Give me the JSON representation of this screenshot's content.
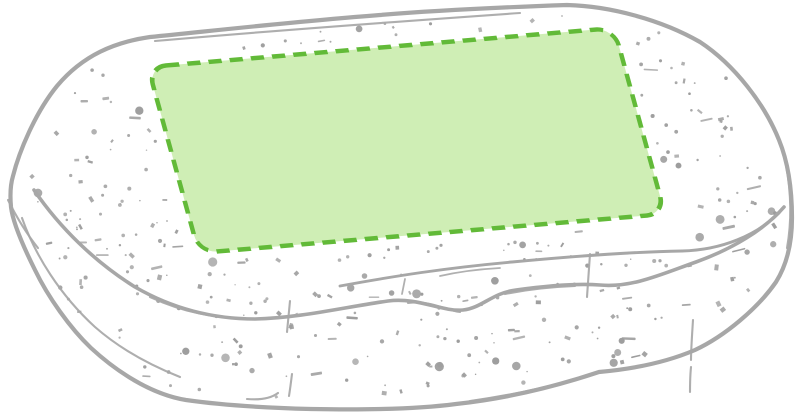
{
  "illustration": {
    "description": "Line-art drawing of a speckled oval box with the printable marking area highlighted in green on the lid",
    "background": "#ffffff"
  },
  "colors": {
    "outline": "#a7a7a7",
    "speckle": "#9d9d9d",
    "marking_fill": "#cfeeb5",
    "marking_stroke": "#62ba38"
  },
  "marking_area": {
    "shape": "rounded-rectangle",
    "dash": "13 8",
    "stroke_width": 4.5,
    "corner_radius": 18
  },
  "speckles": {
    "count": 330,
    "seed": 7
  }
}
